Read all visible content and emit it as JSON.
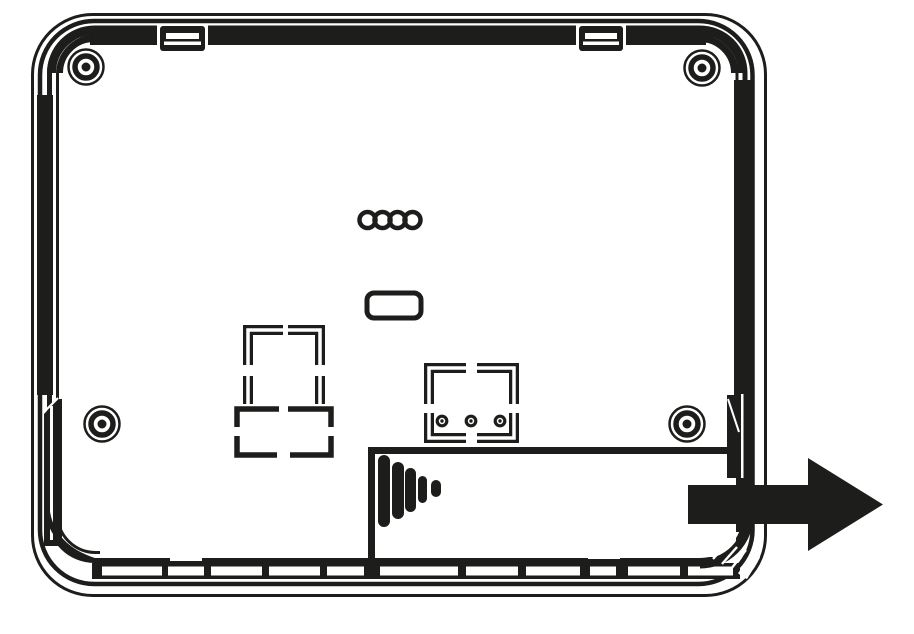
{
  "page": {
    "title": "Device backplate removal diagram",
    "background": "#ffffff",
    "ink": "#1d1d1b"
  },
  "diagram": {
    "description": "Technical line drawing of the rear of a wall-mounted device; a large solid arrow shows the back cover sliding off to the right",
    "view": "rear",
    "arrow": {
      "direction": "right",
      "meaning": "slide cover off",
      "color": "#1d1d1b"
    },
    "counts": {
      "screw_bosses": 4,
      "connector_pins": 3,
      "grip_ridges": 5,
      "cable_holes": 4,
      "top_mounting_tabs": 2,
      "bottom_vent_slots": 11
    }
  }
}
